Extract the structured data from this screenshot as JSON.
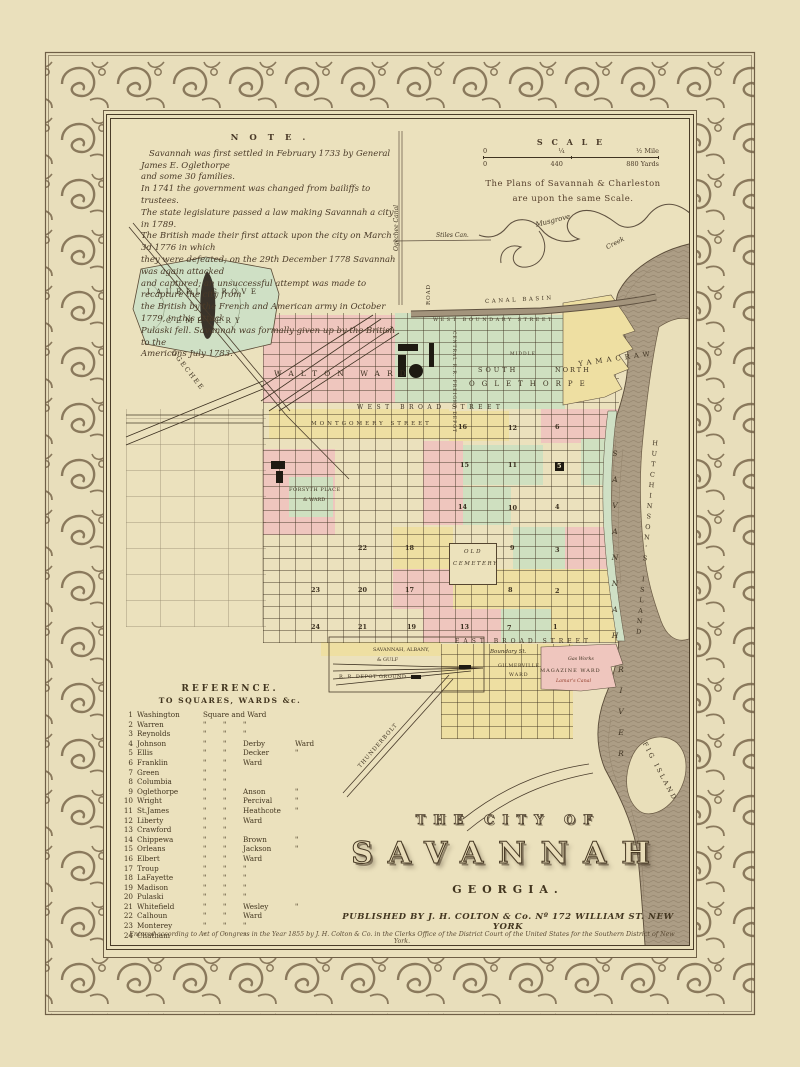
{
  "colors": {
    "paper": "#eae0bc",
    "ink": "#3f3322",
    "ward_pink": "#efc6be",
    "ward_green": "#cfe0c0",
    "ward_yellow": "#eedfa2",
    "river": "#ac9d85",
    "cemetery_green": "#cfe0c5"
  },
  "note": {
    "heading": "N O T E .",
    "lines": [
      "Savannah was first settled in February 1733 by General James E. Oglethorpe",
      "and some 30 families.",
      "In 1741 the government was changed from bailiffs to trustees.",
      "The state legislature passed a law making Savannah a city in 1789.",
      "The British made their first attack upon the city on March 3d 1776 in which",
      "they were defeated; on the 29th December 1778 Savannah was again attacked",
      "and captured; an unsuccessful attempt was made to recapture the city from",
      "the British by the French and American army in October 1779, in this attack",
      "Pulaski fell. Savannah was formally given up by the British to the",
      "Americans July 1783."
    ]
  },
  "scale": {
    "title": "S C A L E",
    "top_left": "0",
    "top_mid": "¼",
    "top_right": "½ Mile",
    "bottom_left": "0",
    "bottom_mid": "440",
    "bottom_right": "880 Yards",
    "caption1": "The Plans of Savannah & Charleston",
    "caption2": "are upon the same Scale."
  },
  "title_block": {
    "line1": "THE CITY OF",
    "line2": "SAVANNAH",
    "line3": "GEORGIA.",
    "publisher": "PUBLISHED BY J. H. COLTON & Co. Nº 172 WILLIAM ST. NEW YORK"
  },
  "copyright": "Entered according to Act of Congress in the Year 1855 by J. H. Colton & Co. in the Clerks Office of the District Court of the United States for the Southern District of New York.",
  "reference": {
    "heading1": "REFERENCE.",
    "heading2": "TO SQUARES, WARDS &c.",
    "rows": [
      {
        "n": "1",
        "name": "Washington",
        "a": "Square and Ward",
        "sp": true
      },
      {
        "n": "2",
        "name": "Warren",
        "a": "\"",
        "b": "\"",
        "c": "\"",
        "d": ""
      },
      {
        "n": "3",
        "name": "Reynolds",
        "a": "\"",
        "b": "\"",
        "c": "\"",
        "d": ""
      },
      {
        "n": "4",
        "name": "Johnson",
        "a": "\"",
        "b": "\"",
        "c": "Derby",
        "d": "Ward"
      },
      {
        "n": "5",
        "name": "Ellis",
        "a": "\"",
        "b": "\"",
        "c": "Decker",
        "d": "\""
      },
      {
        "n": "6",
        "name": "Franklin",
        "a": "\"",
        "b": "\"",
        "c": "Ward",
        "d": ""
      },
      {
        "n": "7",
        "name": "Green",
        "a": "\"",
        "b": "\"",
        "c": "",
        "d": ""
      },
      {
        "n": "8",
        "name": "Columbia",
        "a": "\"",
        "b": "\"",
        "c": "",
        "d": ""
      },
      {
        "n": "9",
        "name": "Oglethorpe",
        "a": "\"",
        "b": "\"",
        "c": "Anson",
        "d": "\""
      },
      {
        "n": "10",
        "name": "Wright",
        "a": "\"",
        "b": "\"",
        "c": "Percival",
        "d": "\""
      },
      {
        "n": "11",
        "name": "St.James",
        "a": "\"",
        "b": "\"",
        "c": "Heathcote",
        "d": "\""
      },
      {
        "n": "12",
        "name": "Liberty",
        "a": "\"",
        "b": "\"",
        "c": "Ward",
        "d": ""
      },
      {
        "n": "13",
        "name": "Crawford",
        "a": "\"",
        "b": "\"",
        "c": "",
        "d": ""
      },
      {
        "n": "14",
        "name": "Chippewa",
        "a": "\"",
        "b": "\"",
        "c": "Brown",
        "d": "\""
      },
      {
        "n": "15",
        "name": "Orleans",
        "a": "\"",
        "b": "\"",
        "c": "Jackson",
        "d": "\""
      },
      {
        "n": "16",
        "name": "Elbert",
        "a": "\"",
        "b": "\"",
        "c": "Ward",
        "d": ""
      },
      {
        "n": "17",
        "name": "Troup",
        "a": "\"",
        "b": "\"",
        "c": "\"",
        "d": ""
      },
      {
        "n": "18",
        "name": "LaFayette",
        "a": "\"",
        "b": "\"",
        "c": "\"",
        "d": ""
      },
      {
        "n": "19",
        "name": "Madison",
        "a": "\"",
        "b": "\"",
        "c": "\"",
        "d": ""
      },
      {
        "n": "20",
        "name": "Pulaski",
        "a": "\"",
        "b": "\"",
        "c": "\"",
        "d": ""
      },
      {
        "n": "21",
        "name": "Whitefield",
        "a": "\"",
        "b": "\"",
        "c": "Wesley",
        "d": "\""
      },
      {
        "n": "22",
        "name": "Calhoun",
        "a": "\"",
        "b": "\"",
        "c": "Ward",
        "d": ""
      },
      {
        "n": "23",
        "name": "Monterey",
        "a": "\"",
        "b": "\"",
        "c": "\"",
        "d": ""
      },
      {
        "n": "24",
        "name": "Chatham",
        "a": "\"",
        "b": "\"",
        "c": "\"",
        "d": ""
      }
    ]
  },
  "map_labels": [
    {
      "id": "ogechee-canal",
      "t": "Ogechee Canal",
      "x": 283,
      "y": 132,
      "fs": 6,
      "cls": "it r-90"
    },
    {
      "id": "stiles-canal",
      "t": "Stiles Can.",
      "x": 325,
      "y": 114,
      "fs": 6,
      "cls": "it"
    },
    {
      "id": "musgrove",
      "t": "Musgrove",
      "x": 424,
      "y": 103,
      "fs": 7,
      "rot": -14,
      "cls": "it"
    },
    {
      "id": "creek",
      "t": "Creek",
      "x": 494,
      "y": 126,
      "fs": 6.5,
      "rot": -28,
      "cls": "it"
    },
    {
      "id": "road-vertical",
      "t": "ROAD",
      "x": 316,
      "y": 186,
      "fs": 5.5,
      "ls": 1,
      "cls": "r-90"
    },
    {
      "id": "canal-basin",
      "t": "CANAL BASIN",
      "x": 374,
      "y": 181,
      "fs": 5.5,
      "ls": 2.5,
      "rot": -3
    },
    {
      "id": "west-boundary-street",
      "t": "WEST BOUNDARY STREET",
      "x": 322,
      "y": 199,
      "fs": 5,
      "ls": 2.5
    },
    {
      "id": "walton-ward",
      "t": "WALTON WARD",
      "x": 163,
      "y": 251,
      "fs": 7.5,
      "ls": 7
    },
    {
      "id": "central-rr-depot",
      "t": "CENTRAL R.R. FREIGHT DEPOT",
      "x": 344,
      "y": 212,
      "fs": 4.5,
      "ls": 1,
      "cls": "r90"
    },
    {
      "id": "middle-ward",
      "t": "MIDDLE",
      "x": 399,
      "y": 234,
      "fs": 4.5,
      "ls": 1
    },
    {
      "id": "south-oglethorpe-1",
      "t": "SOUTH",
      "x": 367,
      "y": 248,
      "fs": 6.5,
      "ls": 3
    },
    {
      "id": "south-oglethorpe-2",
      "t": "OGLETHORPE",
      "x": 358,
      "y": 262,
      "fs": 7,
      "ls": 7
    },
    {
      "id": "north-oglethorpe",
      "t": "NORTH",
      "x": 444,
      "y": 248,
      "fs": 6.5,
      "ls": 2
    },
    {
      "id": "yamacraw-ward",
      "t": "YAMACRAW",
      "x": 467,
      "y": 242,
      "fs": 7,
      "ls": 4,
      "rot": -8
    },
    {
      "id": "west-broad-street",
      "t": "WEST BROAD STREET",
      "x": 246,
      "y": 286,
      "fs": 6,
      "ls": 4.5
    },
    {
      "id": "montgomery-street",
      "t": "MONTGOMERY STREET",
      "x": 200,
      "y": 303,
      "fs": 5.5,
      "ls": 3
    },
    {
      "id": "laurel-grove-1",
      "t": "LAUREL GROVE",
      "x": 36,
      "y": 170,
      "fs": 7,
      "ls": 4.5
    },
    {
      "id": "laurel-grove-2",
      "t": "CEMETERY",
      "x": 55,
      "y": 199,
      "fs": 7,
      "ls": 4.5
    },
    {
      "id": "ogechee-road",
      "t": "OGECHEE",
      "x": 64,
      "y": 230,
      "fs": 6.5,
      "ls": 2,
      "rot": 52
    },
    {
      "id": "forsyth-1",
      "t": "FORSYTH PLACE",
      "x": 178,
      "y": 369,
      "fs": 5,
      "ls": 0.5
    },
    {
      "id": "forsyth-2",
      "t": "& WARD",
      "x": 192,
      "y": 379,
      "fs": 5
    },
    {
      "id": "old-cemetery-1",
      "t": "OLD",
      "x": 353,
      "y": 431,
      "fs": 5.5,
      "ls": 2,
      "cls": "it"
    },
    {
      "id": "old-cemetery-2",
      "t": "CEMETERY",
      "x": 342,
      "y": 443,
      "fs": 5.5,
      "ls": 1.5,
      "cls": "it"
    },
    {
      "id": "east-broad-street",
      "t": "EAST BROAD STREET",
      "x": 344,
      "y": 520,
      "fs": 6,
      "ls": 4
    },
    {
      "id": "boundary-st",
      "t": "Boundary St.",
      "x": 379,
      "y": 531,
      "fs": 5.5,
      "cls": "it"
    },
    {
      "id": "gilmerville-1",
      "t": "GILMERVILLE",
      "x": 387,
      "y": 546,
      "fs": 4.8,
      "ls": 0.5
    },
    {
      "id": "gilmerville-2",
      "t": "WARD",
      "x": 398,
      "y": 555,
      "fs": 4.8,
      "ls": 1
    },
    {
      "id": "magazine-ward",
      "t": "MAGAZINE WARD",
      "x": 429,
      "y": 550,
      "fs": 5,
      "ls": 1
    },
    {
      "id": "gas-works",
      "t": "Gas Works",
      "x": 457,
      "y": 539,
      "fs": 4.8,
      "cls": "it"
    },
    {
      "id": "lamars-canal",
      "t": "Lamar's Canal",
      "x": 445,
      "y": 561,
      "fs": 4.8,
      "cls": "it",
      "col": "#94402e"
    },
    {
      "id": "sagrr-1",
      "t": "SAVANNAH, ALBANY,",
      "x": 262,
      "y": 529,
      "fs": 5
    },
    {
      "id": "sagrr-2",
      "t": "& GULF",
      "x": 266,
      "y": 539,
      "fs": 5
    },
    {
      "id": "sagrr-3",
      "t": "R. R. DEPOT GROUND",
      "x": 228,
      "y": 556,
      "fs": 5,
      "ls": 0.5
    },
    {
      "id": "thunderbolt-road",
      "t": "THUNDERBOLT",
      "x": 247,
      "y": 647,
      "fs": 5.5,
      "ls": 1,
      "rot": -49
    },
    {
      "id": "savannah-river-1",
      "t": "SAVANNAH",
      "x": 500,
      "y": 330,
      "fs": 7.5,
      "ls": 17,
      "cls": "vu it"
    },
    {
      "id": "savannah-river-2",
      "t": "RIVER",
      "x": 506,
      "y": 546,
      "fs": 7.5,
      "ls": 12,
      "cls": "vu it"
    },
    {
      "id": "hutchinsons-island",
      "t": "HUTCHINSON'S ISLAND",
      "x": 541,
      "y": 320,
      "fs": 6.5,
      "ls": 2.5,
      "rot": 5,
      "cls": "vu"
    },
    {
      "id": "fig-island",
      "t": "FIG ISLAND",
      "x": 536,
      "y": 622,
      "fs": 6.5,
      "ls": 2.5,
      "rot": 62
    }
  ],
  "squares": [
    {
      "n": "16",
      "x": 347,
      "y": 305
    },
    {
      "n": "12",
      "x": 397,
      "y": 306
    },
    {
      "n": "6",
      "x": 444,
      "y": 305
    },
    {
      "n": "15",
      "x": 349,
      "y": 343
    },
    {
      "n": "11",
      "x": 397,
      "y": 343
    },
    {
      "n": "5",
      "x": 444,
      "y": 343,
      "dark": true
    },
    {
      "n": "14",
      "x": 347,
      "y": 385
    },
    {
      "n": "10",
      "x": 397,
      "y": 386
    },
    {
      "n": "4",
      "x": 444,
      "y": 385
    },
    {
      "n": "18",
      "x": 294,
      "y": 426
    },
    {
      "n": "9",
      "x": 399,
      "y": 426
    },
    {
      "n": "3",
      "x": 444,
      "y": 428
    },
    {
      "n": "17",
      "x": 294,
      "y": 468
    },
    {
      "n": "8",
      "x": 397,
      "y": 468
    },
    {
      "n": "2",
      "x": 444,
      "y": 469
    },
    {
      "n": "13",
      "x": 349,
      "y": 505
    },
    {
      "n": "7",
      "x": 396,
      "y": 506
    },
    {
      "n": "1",
      "x": 442,
      "y": 505
    },
    {
      "n": "19",
      "x": 296,
      "y": 505
    },
    {
      "n": "20",
      "x": 247,
      "y": 468
    },
    {
      "n": "21",
      "x": 247,
      "y": 505
    },
    {
      "n": "22",
      "x": 247,
      "y": 426
    },
    {
      "n": "23",
      "x": 200,
      "y": 468
    },
    {
      "n": "24",
      "x": 200,
      "y": 505
    }
  ]
}
